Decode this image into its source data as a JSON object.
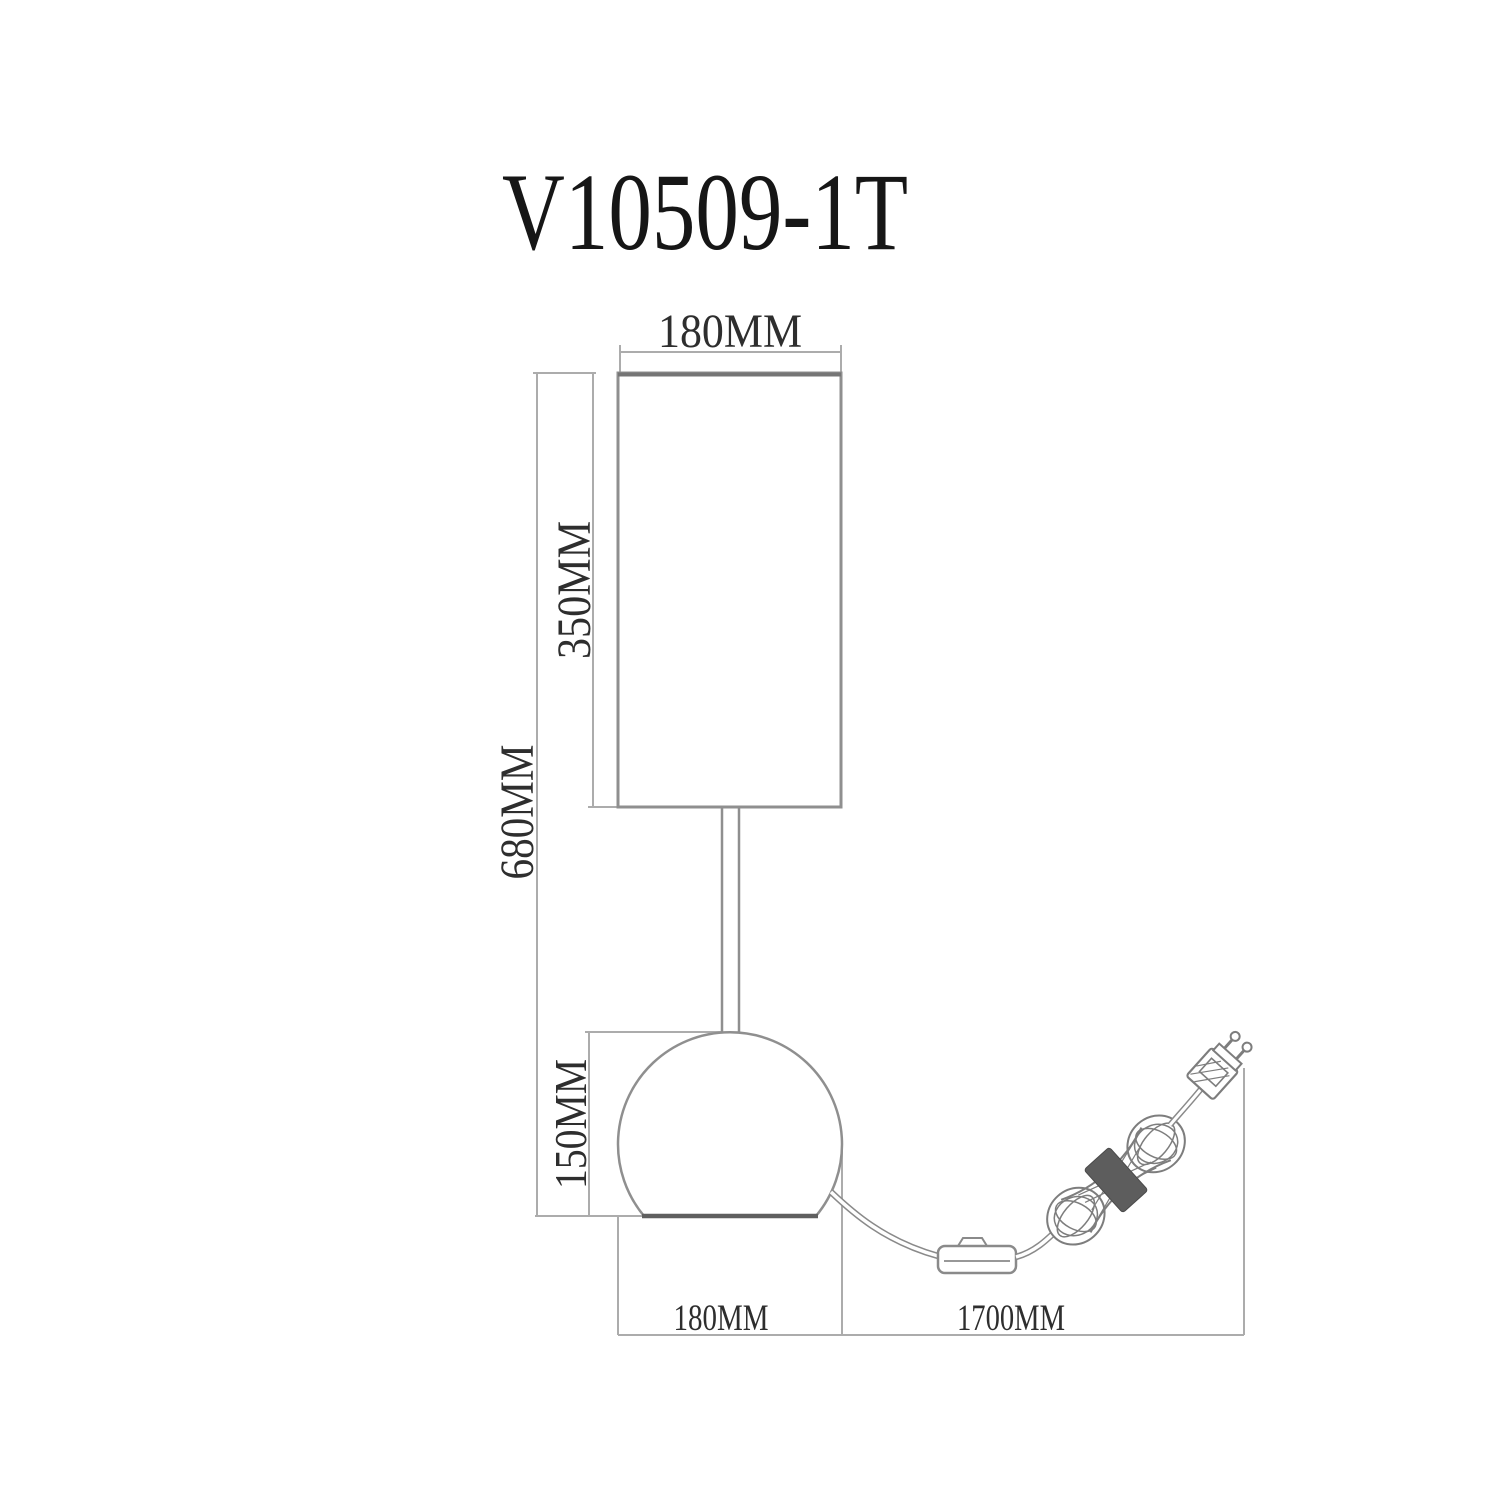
{
  "drawing": {
    "title": "V10509-1T",
    "type_note": "table lamp technical dimension drawing",
    "dimensions": {
      "shade_width": "180MM",
      "shade_height": "350MM",
      "total_height": "680MM",
      "base_height": "150MM",
      "base_width": "180MM",
      "cord_length": "1700MM"
    },
    "colors": {
      "dimension_line": "#acacac",
      "outline": "#8f8f8f",
      "base_bottom": "#5f5f5f",
      "coil_band": "#5d5d5d",
      "label_text": "#2e2e2e",
      "title_text": "#161616"
    }
  }
}
